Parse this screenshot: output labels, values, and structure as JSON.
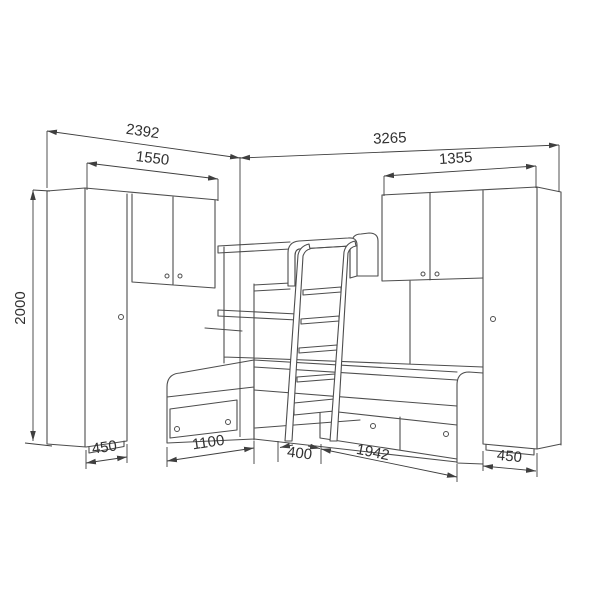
{
  "colors": {
    "background": "#ffffff",
    "line": "#4d4d4d",
    "dim": "#3f3f3f",
    "text": "#303030"
  },
  "dims": {
    "d2392": "2392",
    "d1550": "1550",
    "d3265": "3265",
    "d1355": "1355",
    "d2000": "2000",
    "d450l": "450",
    "d1100": "1100",
    "d400": "400",
    "d1942": "1942",
    "d450r": "450"
  }
}
